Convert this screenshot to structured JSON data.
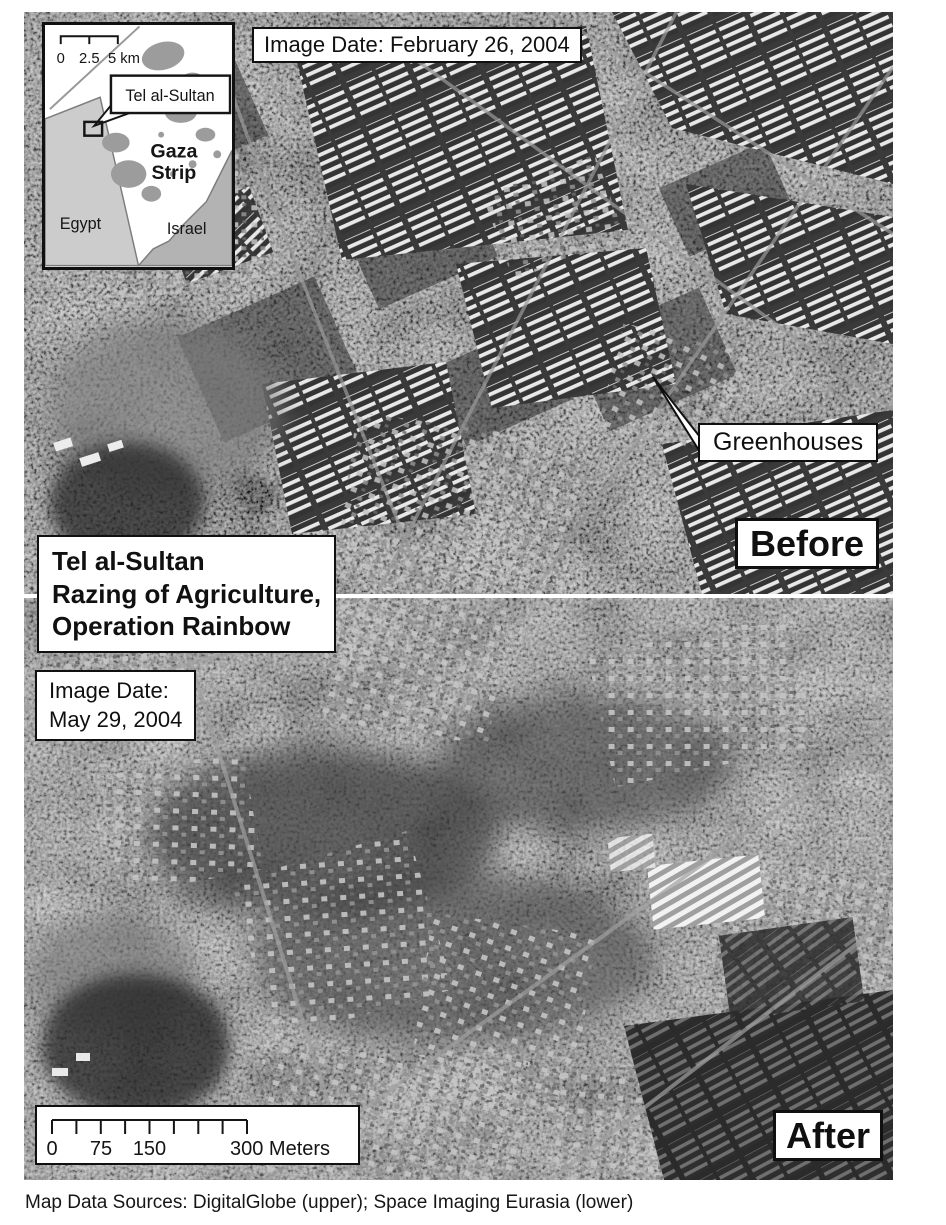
{
  "inset_map": {
    "scale_ticks": [
      "0",
      "2.5",
      "5 km"
    ],
    "marker_label": "Tel al-Sultan",
    "region_label": [
      "Gaza",
      "Strip"
    ],
    "countries": [
      "Egypt",
      "Israel"
    ],
    "colors": {
      "egypt_fill": "#cccccc",
      "israel_fill": "#b3b3b3",
      "gaza_fill": "#ffffff",
      "urban_fill": "#9c9c9c"
    }
  },
  "before_panel": {
    "image_date_label": "Image Date: February 26, 2004",
    "annotation": "Greenhouses",
    "badge": "Before"
  },
  "title_box": {
    "lines": [
      "Tel al-Sultan",
      "Razing of Agriculture,",
      "Operation Rainbow"
    ]
  },
  "after_panel": {
    "image_date_lines": [
      "Image Date:",
      "May 29, 2004"
    ],
    "badge": "After",
    "scale_bar": {
      "ticks": [
        "0",
        "75",
        "150",
        "300 Meters"
      ]
    }
  },
  "caption": "Map Data Sources: DigitalGlobe (upper); Space Imaging Eurasia (lower)"
}
